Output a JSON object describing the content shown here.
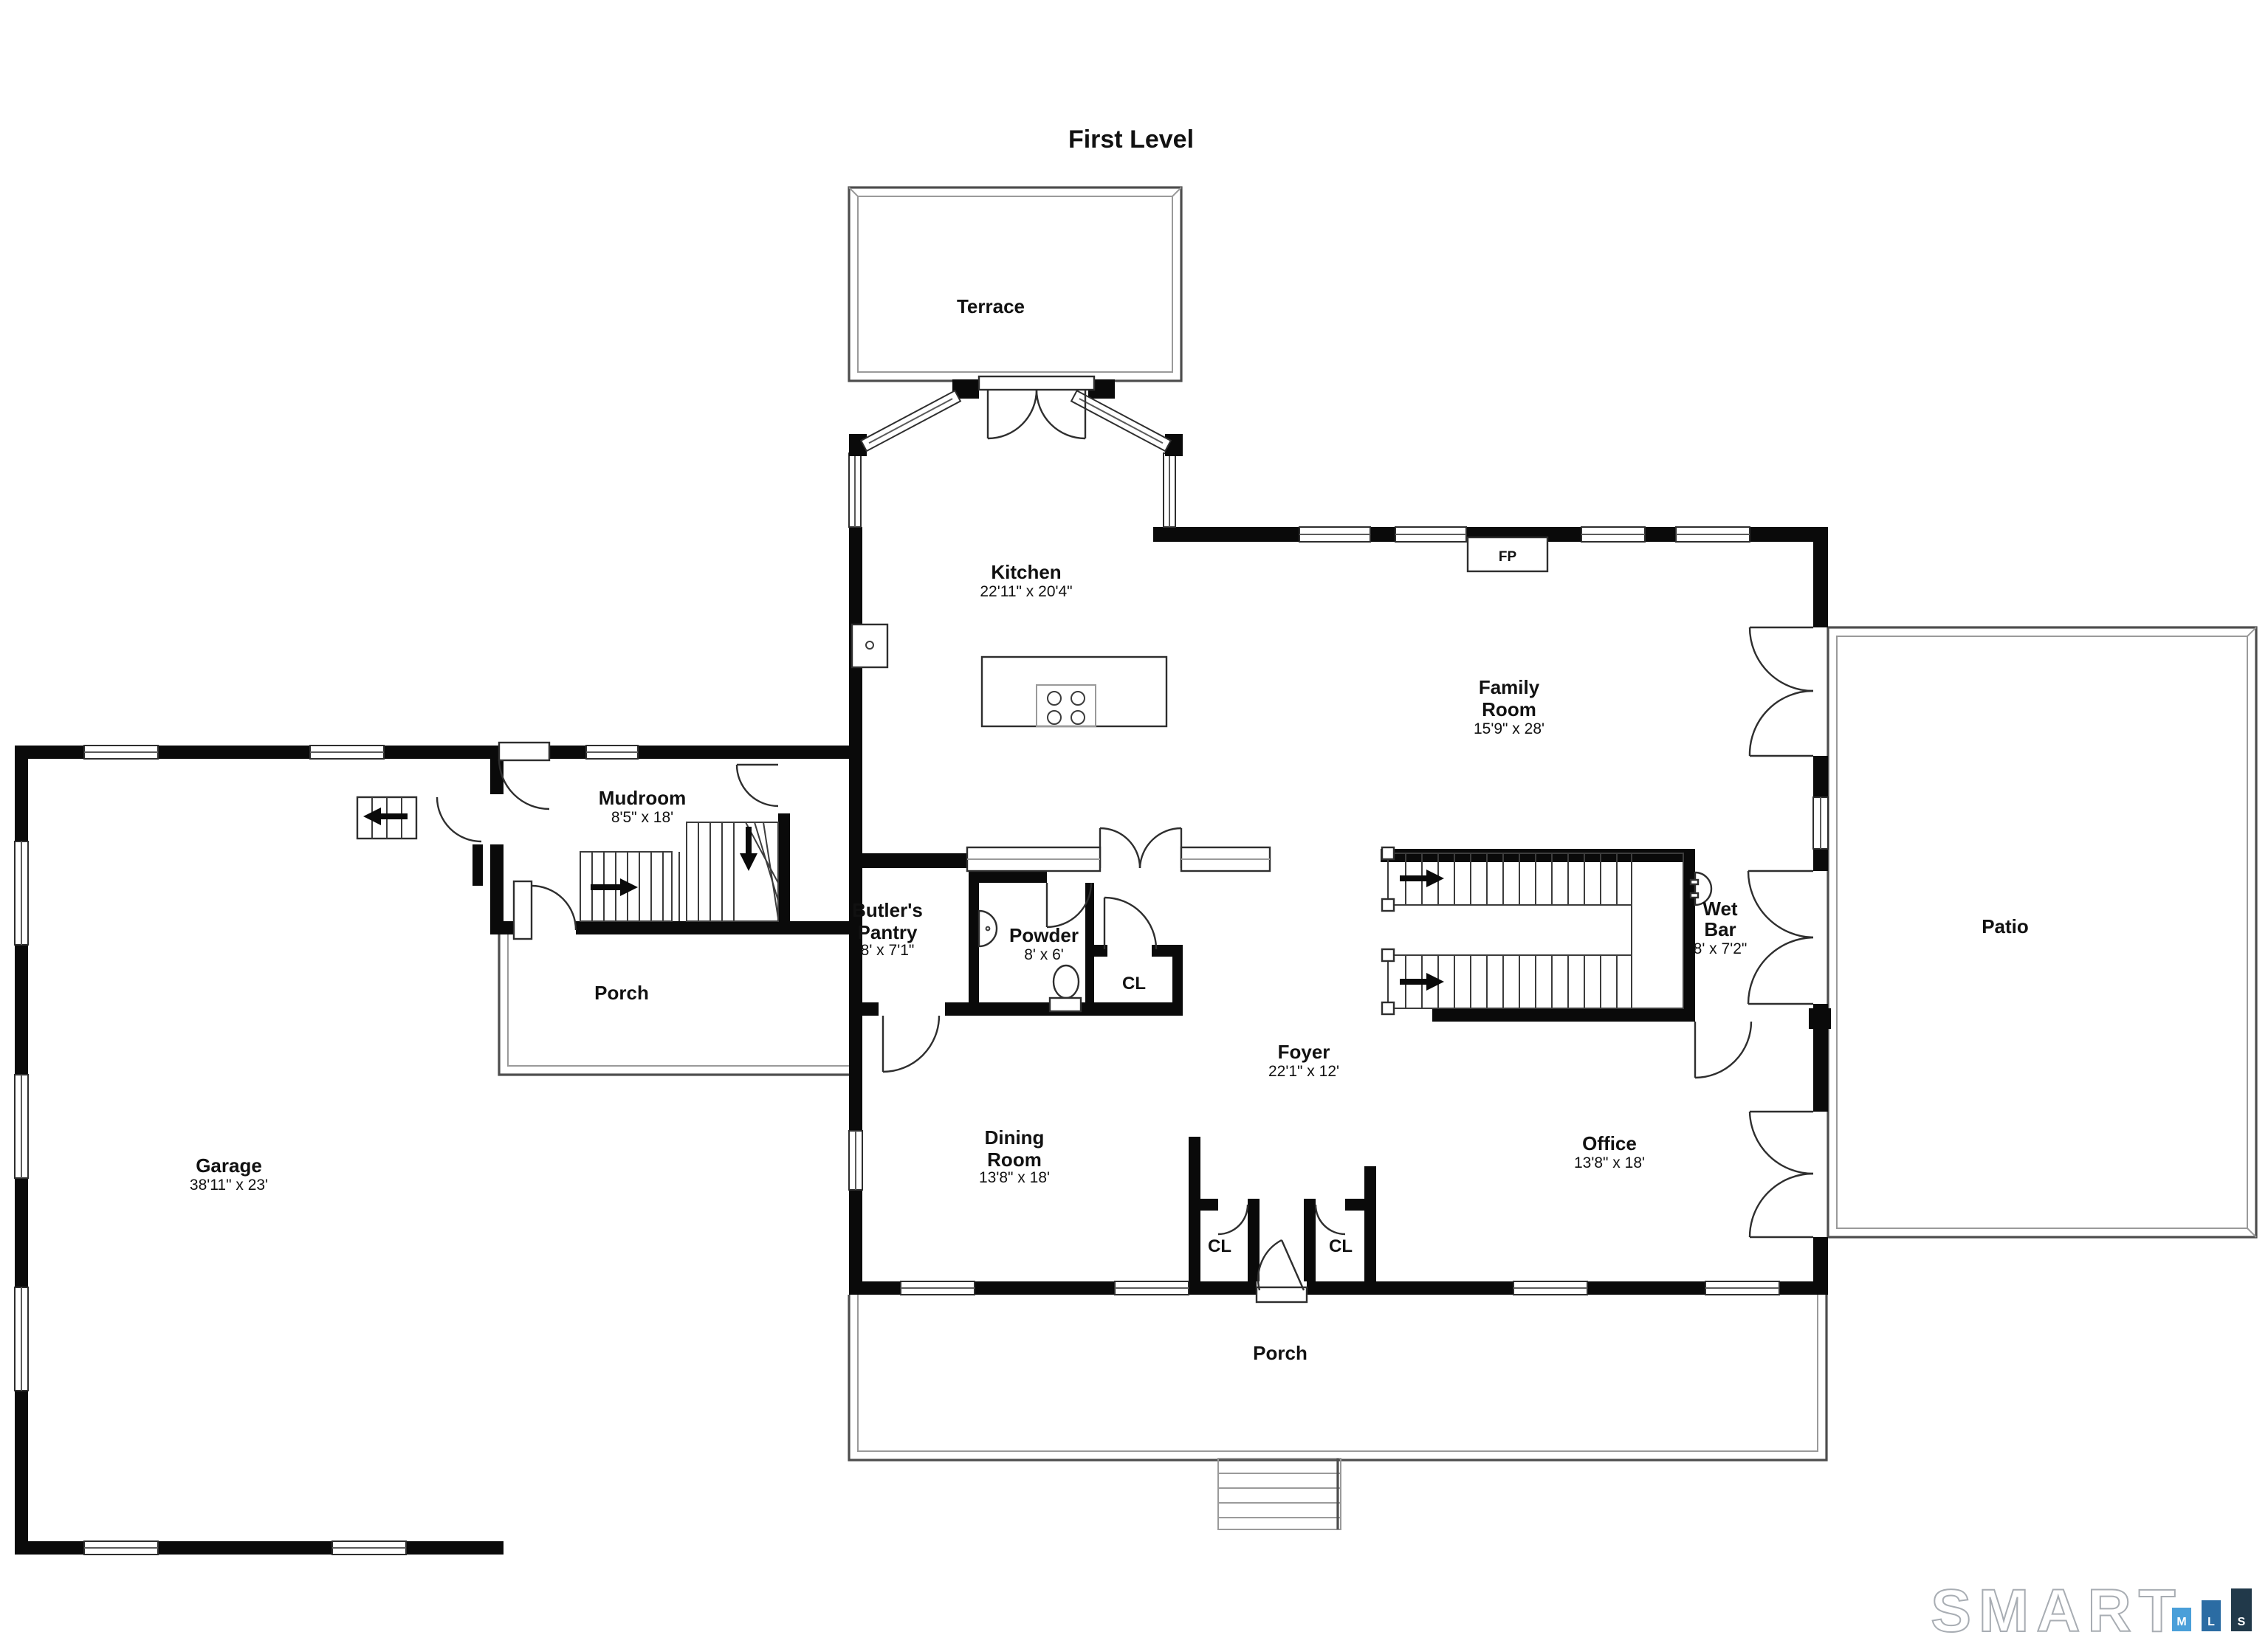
{
  "title": "First Level",
  "rooms": {
    "terrace": {
      "name": "Terrace"
    },
    "kitchen": {
      "name": "Kitchen",
      "dims": "22'11\" x 20'4\""
    },
    "family_room": {
      "line1": "Family",
      "line2": "Room",
      "dims": "15'9\" x 28'"
    },
    "mudroom": {
      "name": "Mudroom",
      "dims": "8'5\" x 18'"
    },
    "butlers_pantry": {
      "line1": "Butler's",
      "line2": "Pantry",
      "dims": "8' x 7'1\""
    },
    "powder": {
      "name": "Powder",
      "dims": "8' x 6'"
    },
    "closet_hall": {
      "name": "CL"
    },
    "foyer": {
      "name": "Foyer",
      "dims": "22'1\" x 12'"
    },
    "dining_room": {
      "line1": "Dining",
      "line2": "Room",
      "dims": "13'8\" x 18'"
    },
    "closet_front_left": {
      "name": "CL"
    },
    "closet_front_right": {
      "name": "CL"
    },
    "office": {
      "name": "Office",
      "dims": "13'8\" x 18'"
    },
    "wet_bar": {
      "line1": "Wet",
      "line2": "Bar",
      "dims": "8' x 7'2\""
    },
    "garage": {
      "name": "Garage",
      "dims": "38'11\" x 23'"
    },
    "patio": {
      "name": "Patio"
    },
    "porch_side": {
      "name": "Porch"
    },
    "porch_front": {
      "name": "Porch"
    }
  },
  "annotations": {
    "fireplace": "FP"
  },
  "logo": {
    "word": "SMART",
    "bars": [
      {
        "letter": "M",
        "color": "#4A9FD9"
      },
      {
        "letter": "L",
        "color": "#2B6CA3"
      },
      {
        "letter": "S",
        "color": "#21394A"
      }
    ]
  }
}
